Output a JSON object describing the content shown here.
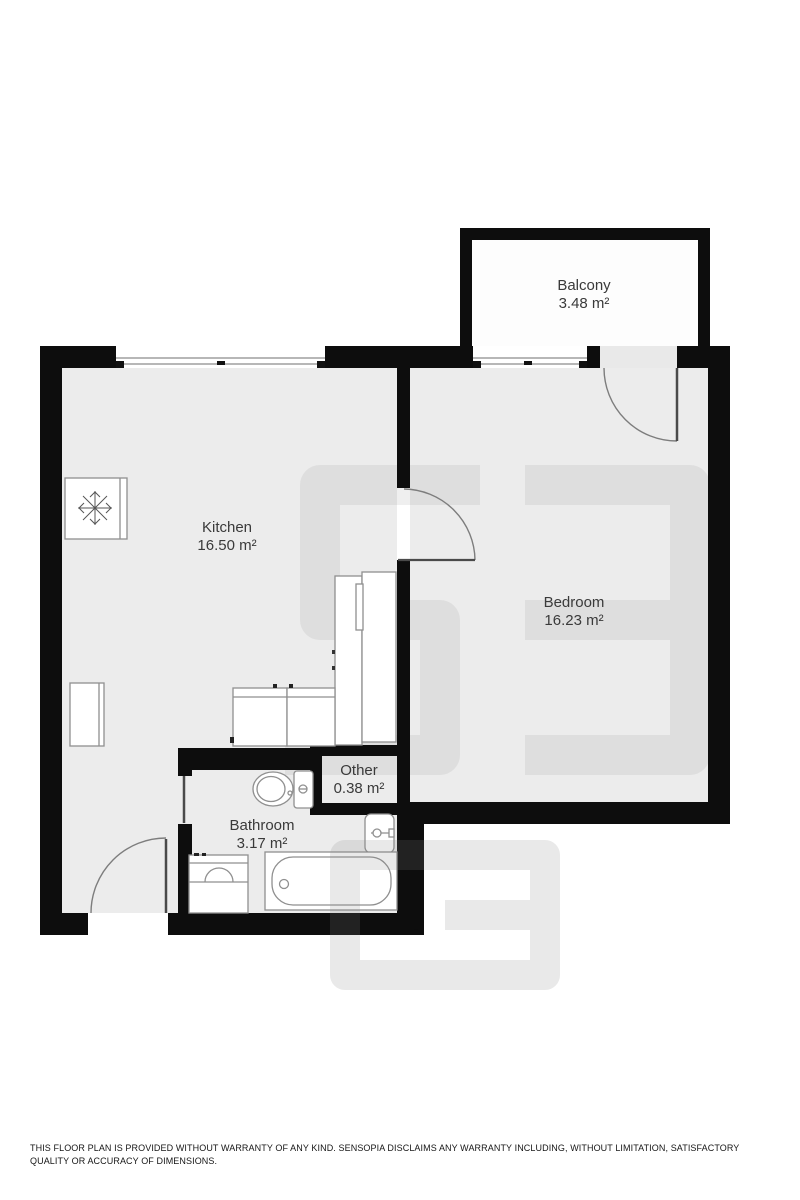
{
  "page": {
    "background_color": "#ffffff"
  },
  "plan": {
    "wall_color": "#0d0d0d",
    "floor_color": "#ececec",
    "balcony_floor_color": "#fdfdfd",
    "rooms": [
      {
        "id": "balcony",
        "name": "Balcony",
        "area": "3.48 m²"
      },
      {
        "id": "kitchen",
        "name": "Kitchen",
        "area": "16.50 m²"
      },
      {
        "id": "bedroom",
        "name": "Bedroom",
        "area": "16.23 m²"
      },
      {
        "id": "other",
        "name": "Other",
        "area": "0.38 m²"
      },
      {
        "id": "bathroom",
        "name": "Bathroom",
        "area": "3.17 m²"
      }
    ],
    "fixtures": [
      "fridge-snowflake-icon",
      "kitchen-base-cabinets",
      "kitchen-tall-unit",
      "side-cabinet",
      "toilet",
      "wash-basin",
      "bathtub",
      "vanity-sink"
    ],
    "doors": [
      "entry-door",
      "bathroom-door",
      "bedroom-door",
      "balcony-door"
    ],
    "windows": [
      "kitchen-window",
      "bedroom-window"
    ]
  },
  "footer": {
    "disclaimer": "THIS FLOOR PLAN IS PROVIDED WITHOUT WARRANTY OF ANY KIND. SENSOPIA DISCLAIMS ANY WARRANTY INCLUDING, WITHOUT LIMITATION, SATISFACTORY QUALITY OR ACCURACY OF DIMENSIONS."
  }
}
